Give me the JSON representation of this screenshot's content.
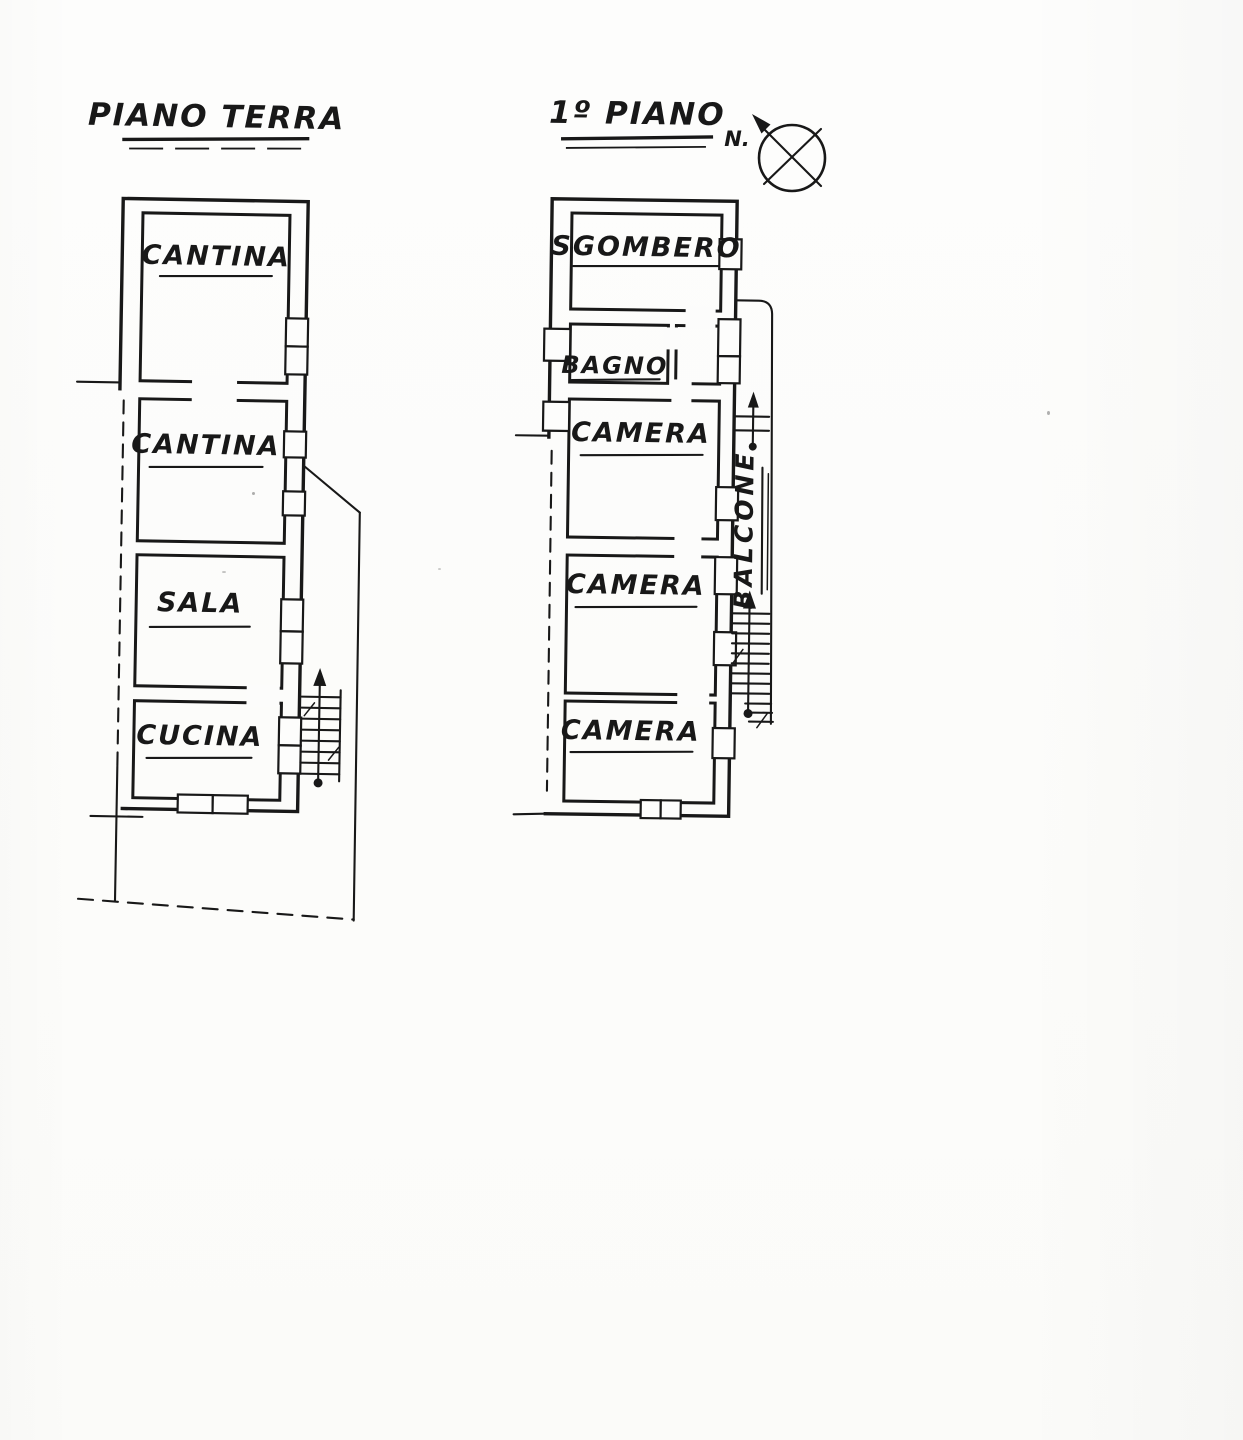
{
  "sheet": {
    "description_label_count": 2
  },
  "plans": {
    "ground_floor": {
      "title": "PIANO TERRA",
      "rooms": [
        {
          "label": "CANTINA"
        },
        {
          "label": "CANTINA"
        },
        {
          "label": "SALA"
        },
        {
          "label": "CUCINA"
        }
      ]
    },
    "first_floor": {
      "title": "1º PIANO",
      "rooms": [
        {
          "label": "SGOMBERO"
        },
        {
          "label": "BAGNO"
        },
        {
          "label": "CAMERA"
        },
        {
          "label": "CAMERA"
        },
        {
          "label": "CAMERA"
        }
      ],
      "balcony_label": "BALCONE"
    }
  },
  "compass": {
    "north_label": "N."
  },
  "colors": {
    "ink": "#181818",
    "paper": "#fcfcfb"
  }
}
